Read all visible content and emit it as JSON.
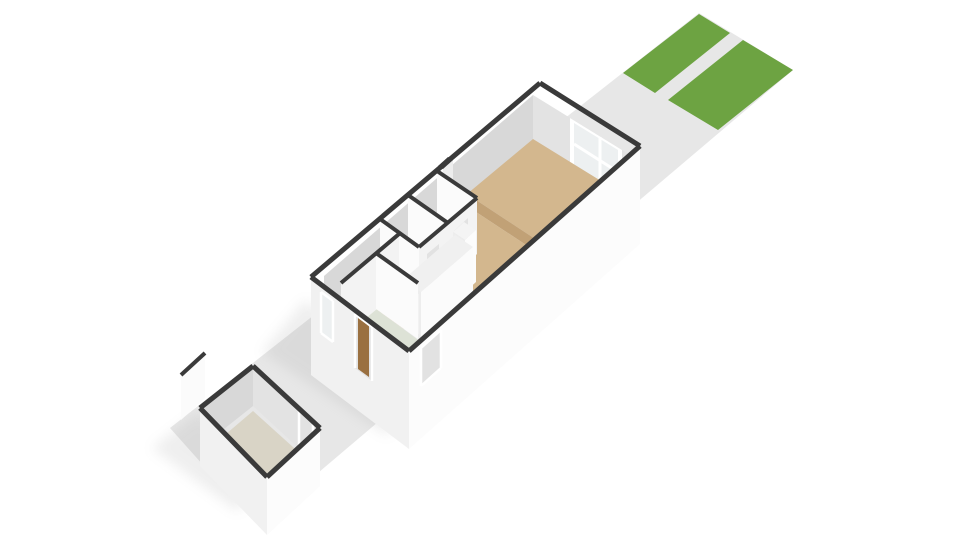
{
  "scene": {
    "kind": "isometric-3d-floorplan-render",
    "description": "Ground floor of a narrow terraced house plotted on a long strip: rear garden with two grass patches and a paved path (top right), main house with raised living area, big rear window, two small white-floored rooms, wooden staircase block, sage-colored kitchen/entry floor, and a detached storage shed with a freestanding garden wall (bottom left).",
    "elements": {
      "plot": "paved-ground-strip",
      "garden": [
        "grass-patch-left",
        "grass-patch-right",
        "garden-path"
      ],
      "main_house": [
        "living-area-raised-platform",
        "platform-steps",
        "rear-window",
        "chimney-column",
        "bathroom",
        "small-room",
        "hallway-tan-floor",
        "stair-enclosure-with-wood-stairs",
        "closet-column",
        "entry-sage-floor",
        "kitchen-sage-strip",
        "storage-closet",
        "front-door",
        "front-window",
        "side-door"
      ],
      "outbuilding": [
        "storage-shed",
        "shed-doorway",
        "freestanding-garden-wall"
      ]
    }
  },
  "colors": {
    "background": "#ffffff",
    "ground": "#e7e7e7",
    "grass": "#6da342",
    "wallCap": "#3a3a3a",
    "extFaceLight": "#fcfcfc",
    "extFaceShade": "#f1f1f1",
    "intFaceGray": "#d8d8d8",
    "intFaceLight": "#e3e3e3",
    "intWallFace": "#fbfbfb",
    "intWallFaceShade": "#f3f3f3",
    "floorTan": "#d3b78e",
    "floorTanEdge": "#c1a176",
    "floorPale": "#f4f4f4",
    "floorSage": "#dde2d6",
    "floorShed": "#d9d4c6",
    "stairTop": "#f0f0f0",
    "stairFaceLight": "#fbfbfb",
    "stairFaceShade": "#ededed",
    "wood": "#a5824e",
    "doorWood": "#9a7040",
    "glass": "#edf0f1",
    "frameWhite": "#ffffff",
    "openingGray": "#e2e2e2",
    "shadow": "#9b9b9b",
    "stepShade": "#e6e6e6"
  }
}
